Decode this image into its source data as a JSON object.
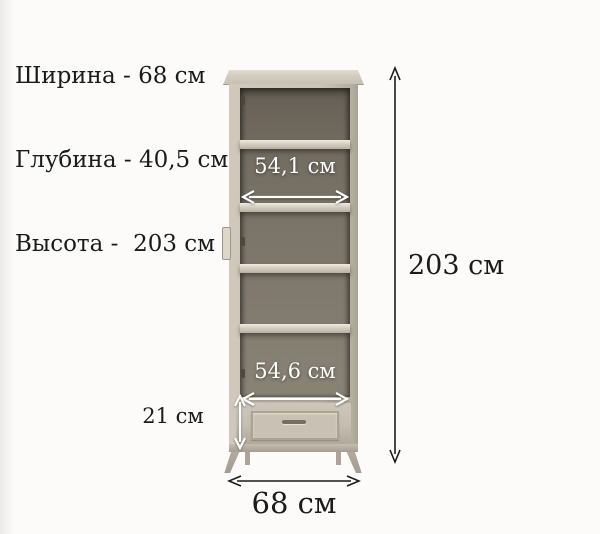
{
  "specs": {
    "lines": [
      "Ширина - 68 см",
      "Глубина - 40,5 см",
      "Высота -  203 см"
    ]
  },
  "dimensions": {
    "total_height": "203 см",
    "total_width": "68 см",
    "inner_width_top": "54,1 см",
    "inner_width_bottom": "54,6 см",
    "drawer_section_height": "21 см"
  },
  "colors": {
    "cabinet_frame": "#cac3b6",
    "cabinet_interior": "#7a7468",
    "dimension_line_dark": "#1b1b1b",
    "dimension_line_white": "#ffffff",
    "text": "#1b1b1b",
    "background": "#fcfbfa"
  }
}
